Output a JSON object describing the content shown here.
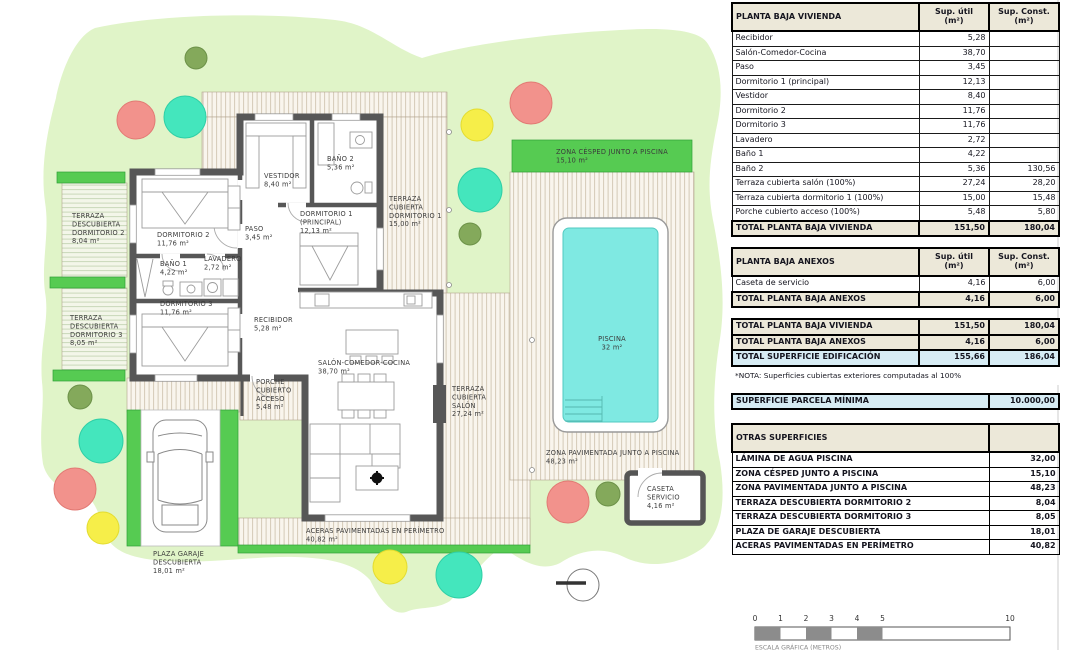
{
  "palette": {
    "parcel_green": "#e0f4c8",
    "lawn_green": "#56cb52",
    "pool_water": "#7fe9e2",
    "tree_red": "#f2928c",
    "tree_teal": "#44e6bd",
    "tree_yellow": "#f6ee49",
    "tree_olive": "#84a95b",
    "wall_gray": "#575757",
    "deck_cream": "#f9f5ed",
    "deck_line": "#d4c9b6",
    "table_header_bg": "#ece8d9",
    "highlight_blue": "#d7ecf4"
  },
  "plan": {
    "labels": [
      {
        "x": 72,
        "y": 218,
        "lines": [
          "TERRAZA",
          "DESCUBIERTA",
          "DORMITORIO 2",
          "8,04 m²"
        ]
      },
      {
        "x": 70,
        "y": 320,
        "lines": [
          "TERRAZA",
          "DESCUBIERTA",
          "DORMITORIO 3",
          "8,05 m²"
        ]
      },
      {
        "x": 157,
        "y": 237,
        "lines": [
          "DORMITORIO 2",
          "11,76 m²"
        ]
      },
      {
        "x": 245,
        "y": 231,
        "lines": [
          "PASO",
          "3,45 m²"
        ]
      },
      {
        "x": 160,
        "y": 266,
        "lines": [
          "BAÑO 1",
          "4,22 m²"
        ]
      },
      {
        "x": 204,
        "y": 261,
        "lines": [
          "LAVADERO",
          "2,72 m²"
        ]
      },
      {
        "x": 160,
        "y": 306,
        "lines": [
          "DORMITORIO 3",
          "11,76 m²"
        ]
      },
      {
        "x": 254,
        "y": 322,
        "lines": [
          "RECIBIDOR",
          "5,28 m²"
        ]
      },
      {
        "x": 264,
        "y": 178,
        "lines": [
          "VESTIDOR",
          "8,40 m²"
        ]
      },
      {
        "x": 327,
        "y": 161,
        "lines": [
          "BAÑO 2",
          "5,36 m²"
        ]
      },
      {
        "x": 300,
        "y": 216,
        "lines": [
          "DORMITORIO 1",
          "(PRINCIPAL)",
          "12,13 m²"
        ]
      },
      {
        "x": 389,
        "y": 201,
        "lines": [
          "TERRAZA",
          "CUBIERTA",
          "DORMITORIO 1",
          "15,00 m²"
        ]
      },
      {
        "x": 556,
        "y": 154,
        "lines": [
          "ZONA CÉSPED JUNTO A PISCINA",
          "15,10 m²"
        ]
      },
      {
        "x": 318,
        "y": 365,
        "lines": [
          "SALÓN-COMEDOR-COCINA",
          "38,70 m²"
        ]
      },
      {
        "x": 256,
        "y": 384,
        "lines": [
          "PORCHE",
          "CUBIERTO",
          "ACCESO",
          "5,48 m²"
        ]
      },
      {
        "x": 452,
        "y": 391,
        "lines": [
          "TERRAZA",
          "CUBIERTA",
          "SALÓN",
          "27,24 m²"
        ]
      },
      {
        "x": 612,
        "y": 341,
        "anchor": "middle",
        "lines": [
          "PISCINA",
          "32 m²"
        ]
      },
      {
        "x": 546,
        "y": 455,
        "lines": [
          "ZONA PAVIMENTADA JUNTO A PISCINA",
          "48,23 m²"
        ]
      },
      {
        "x": 647,
        "y": 491,
        "lines": [
          "CASETA",
          "SERVICIO",
          "4,16 m²"
        ]
      },
      {
        "x": 306,
        "y": 533,
        "lines": [
          "ACERAS PAVIMENTADAS EN PERÍMETRO",
          "40,82 m²"
        ]
      },
      {
        "x": 153,
        "y": 556,
        "lines": [
          "PLAZA GARAJE",
          "DESCUBIERTA",
          "18,01 m²"
        ]
      }
    ],
    "scale": {
      "ticks": [
        {
          "v": 0,
          "label": "0"
        },
        {
          "v": 1,
          "label": "1"
        },
        {
          "v": 2,
          "label": "2"
        },
        {
          "v": 3,
          "label": "3"
        },
        {
          "v": 4,
          "label": "4"
        },
        {
          "v": 5,
          "label": "5"
        },
        {
          "v": 10,
          "label": "10"
        }
      ],
      "caption": "ESCALA GRÁFICA (METROS)"
    }
  },
  "tables": [
    {
      "id": "vivienda",
      "rows": [
        {
          "cls": "hdr",
          "cells": [
            {
              "t": "PLANTA BAJA VIVIENDA",
              "c": "l"
            },
            {
              "t": "Sup. útil\n(m²)",
              "c": "c"
            },
            {
              "t": "Sup. Const.\n(m²)",
              "c": "c"
            }
          ]
        },
        {
          "cells": [
            {
              "t": "Recibidor",
              "c": "l"
            },
            {
              "t": "5,28",
              "c": "r"
            },
            {
              "t": "",
              "c": "r"
            }
          ]
        },
        {
          "cells": [
            {
              "t": "Salón-Comedor-Cocina",
              "c": "l"
            },
            {
              "t": "38,70",
              "c": "r"
            },
            {
              "t": "",
              "c": "r"
            }
          ]
        },
        {
          "cells": [
            {
              "t": "Paso",
              "c": "l"
            },
            {
              "t": "3,45",
              "c": "r"
            },
            {
              "t": "",
              "c": "r"
            }
          ]
        },
        {
          "cells": [
            {
              "t": "Dormitorio 1 (principal)",
              "c": "l"
            },
            {
              "t": "12,13",
              "c": "r"
            },
            {
              "t": "",
              "c": "r"
            }
          ]
        },
        {
          "cells": [
            {
              "t": "Vestidor",
              "c": "l"
            },
            {
              "t": "8,40",
              "c": "r"
            },
            {
              "t": "",
              "c": "r"
            }
          ]
        },
        {
          "cells": [
            {
              "t": "Dormitorio 2",
              "c": "l"
            },
            {
              "t": "11,76",
              "c": "r"
            },
            {
              "t": "",
              "c": "r"
            }
          ]
        },
        {
          "cells": [
            {
              "t": "Dormitorio 3",
              "c": "l"
            },
            {
              "t": "11,76",
              "c": "r"
            },
            {
              "t": "",
              "c": "r"
            }
          ]
        },
        {
          "cells": [
            {
              "t": "Lavadero",
              "c": "l"
            },
            {
              "t": "2,72",
              "c": "r"
            },
            {
              "t": "",
              "c": "r"
            }
          ]
        },
        {
          "cells": [
            {
              "t": "Baño 1",
              "c": "l"
            },
            {
              "t": "4,22",
              "c": "r"
            },
            {
              "t": "",
              "c": "r"
            }
          ]
        },
        {
          "cells": [
            {
              "t": "Baño 2",
              "c": "l"
            },
            {
              "t": "5,36",
              "c": "r"
            },
            {
              "t": "130,56",
              "c": "r"
            }
          ]
        },
        {
          "cells": [
            {
              "t": "Terraza cubierta salón (100%)",
              "c": "l"
            },
            {
              "t": "27,24",
              "c": "r"
            },
            {
              "t": "28,20",
              "c": "r"
            }
          ]
        },
        {
          "cells": [
            {
              "t": "Terraza cubierta dormitorio 1 (100%)",
              "c": "l"
            },
            {
              "t": "15,00",
              "c": "r"
            },
            {
              "t": "15,48",
              "c": "r"
            }
          ]
        },
        {
          "cells": [
            {
              "t": "Porche cubierto acceso (100%)",
              "c": "l"
            },
            {
              "t": "5,48",
              "c": "r"
            },
            {
              "t": "5,80",
              "c": "r"
            }
          ]
        },
        {
          "cls": "total",
          "cells": [
            {
              "t": "TOTAL PLANTA BAJA VIVIENDA",
              "c": "l"
            },
            {
              "t": "151,50",
              "c": "r"
            },
            {
              "t": "180,04",
              "c": "r"
            }
          ]
        }
      ]
    },
    {
      "id": "anexos",
      "rows": [
        {
          "cls": "hdr",
          "cells": [
            {
              "t": "PLANTA BAJA ANEXOS",
              "c": "l"
            },
            {
              "t": "Sup. útil\n(m²)",
              "c": "c"
            },
            {
              "t": "Sup. Const.\n(m²)",
              "c": "c"
            }
          ]
        },
        {
          "cells": [
            {
              "t": "Caseta de servicio",
              "c": "l"
            },
            {
              "t": "4,16",
              "c": "r"
            },
            {
              "t": "6,00",
              "c": "r"
            }
          ]
        },
        {
          "cls": "total",
          "cells": [
            {
              "t": "TOTAL PLANTA BAJA ANEXOS",
              "c": "l"
            },
            {
              "t": "4,16",
              "c": "r"
            },
            {
              "t": "6,00",
              "c": "r"
            }
          ]
        }
      ]
    },
    {
      "id": "totales",
      "rows": [
        {
          "cls": "total",
          "cells": [
            {
              "t": "TOTAL PLANTA BAJA VIVIENDA",
              "c": "l"
            },
            {
              "t": "151,50",
              "c": "r"
            },
            {
              "t": "180,04",
              "c": "r"
            }
          ]
        },
        {
          "cls": "total",
          "cells": [
            {
              "t": "TOTAL PLANTA BAJA ANEXOS",
              "c": "l"
            },
            {
              "t": "4,16",
              "c": "r"
            },
            {
              "t": "6,00",
              "c": "r"
            }
          ]
        },
        {
          "cls": "blue",
          "cells": [
            {
              "t": "TOTAL SUPERFICIE EDIFICACIÓN",
              "c": "l"
            },
            {
              "t": "155,66",
              "c": "r"
            },
            {
              "t": "186,04",
              "c": "r"
            }
          ]
        },
        {
          "cls": "note",
          "cells": [
            {
              "t": "*NOTA: Superficies cubiertas exteriores computadas al 100%",
              "c": "l",
              "s": 3
            }
          ]
        }
      ]
    },
    {
      "id": "parcela",
      "rows": [
        {
          "cls": "blue",
          "cells": [
            {
              "t": "SUPERFICIE PARCELA MÍNIMA",
              "c": "l",
              "s": 2
            },
            {
              "t": "10.000,00",
              "c": "r"
            }
          ]
        }
      ]
    },
    {
      "id": "otras",
      "rows": [
        {
          "cls": "hdr",
          "cells": [
            {
              "t": "OTRAS SUPERFICIES",
              "c": "l",
              "s": 2
            },
            {
              "t": "",
              "c": "r"
            }
          ]
        },
        {
          "cls": "strong",
          "cells": [
            {
              "t": "LÁMINA DE AGUA PISCINA",
              "c": "l",
              "s": 2
            },
            {
              "t": "32,00",
              "c": "r"
            }
          ]
        },
        {
          "cls": "strong",
          "cells": [
            {
              "t": "ZONA CÉSPED JUNTO A PISCINA",
              "c": "l",
              "s": 2
            },
            {
              "t": "15,10",
              "c": "r"
            }
          ]
        },
        {
          "cls": "strong",
          "cells": [
            {
              "t": "ZONA PAVIMENTADA JUNTO A PISCINA",
              "c": "l",
              "s": 2
            },
            {
              "t": "48,23",
              "c": "r"
            }
          ]
        },
        {
          "cls": "strong",
          "cells": [
            {
              "t": "TERRAZA DESCUBIERTA DORMITORIO 2",
              "c": "l",
              "s": 2
            },
            {
              "t": "8,04",
              "c": "r"
            }
          ]
        },
        {
          "cls": "strong",
          "cells": [
            {
              "t": "TERRAZA DESCUBIERTA DORMITORIO 3",
              "c": "l",
              "s": 2
            },
            {
              "t": "8,05",
              "c": "r"
            }
          ]
        },
        {
          "cls": "strong",
          "cells": [
            {
              "t": "PLAZA DE GARAJE DESCUBIERTA",
              "c": "l",
              "s": 2
            },
            {
              "t": "18,01",
              "c": "r"
            }
          ]
        },
        {
          "cls": "strong",
          "cells": [
            {
              "t": "ACERAS PAVIMENTADAS EN PERÍMETRO",
              "c": "l",
              "s": 2
            },
            {
              "t": "40,82",
              "c": "r"
            }
          ]
        }
      ]
    }
  ]
}
